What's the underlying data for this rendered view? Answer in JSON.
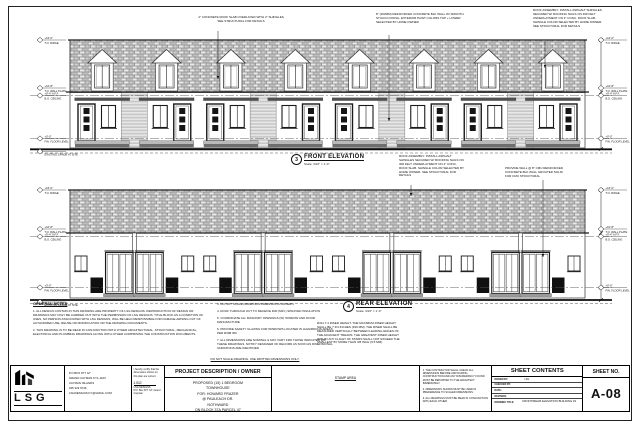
{
  "sheet": {
    "building": {
      "dormers": 8,
      "units": 8,
      "unit_pairs": 4
    },
    "front": {
      "number": "3",
      "title": "FRONT ELEVATION",
      "scale": "Scale: 3/16\" = 1'-0\"",
      "note_roof_slab": "4\" CONCRETE ROOF SLAB OVERLAYED WITH 2\" SHINGLES SEE STRUCTURAL FOR DETAILS",
      "note_wall": "8\" (203MM) REINFORCED CONCRETE BLK WALL W/ SMOOTH STUCCO FINISH. EXTERIOR PAINT COLORS TOP + LOWER SELECTED BY HOME OWNER",
      "levels": [
        {
          "y": 40,
          "elev": "+16'-0\"",
          "name": "T.O. RIDGE"
        },
        {
          "y": 88,
          "elev": "+10'-8\"",
          "name": "T.O. WALL PLATE"
        },
        {
          "y": 95.5,
          "elev": "+9'-4\" A.F.F.",
          "name": "B.O. CEILING"
        },
        {
          "y": 138.5,
          "elev": "+0'-0\"",
          "name": "FIN. FLOOR LEVEL"
        },
        {
          "y": 151.5,
          "elev": "",
          "name": "EXISTING GRADE AT SITE"
        }
      ]
    },
    "rear": {
      "number": "4",
      "title": "REAR ELEVATION",
      "scale": "Scale: 3/16\" = 1'-0\"",
      "note_wall": "PROVIDE WALL @ 8\" CMU REINFORCED CONCRETE BLK WALL GROUTED SOLID FOR CMU STRUCTURAL",
      "note_riser": "R311.7.4 RISER HEIGHT. THE MAXIMUM RISER HEIGHT SHALL BE 7 3/4 INCHES (196 MM). THE RISER SHALL BE MEASURED VERTICALLY BETWEEN LEADING EDGES OF THE ADJACENT TREADS. THE GREATEST RISER HEIGHT WITHIN ANY FLIGHT OF STAIRS SHALL NOT EXCEED THE SMALLEST BY MORE THAN 3/8 INCH (9.5 MM).",
      "levels": [
        {
          "y": 190,
          "elev": "+16'-0\"",
          "name": "T.O. RIDGE"
        },
        {
          "y": 229,
          "elev": "+10'-8\"",
          "name": "T.O. WALL PLATE"
        },
        {
          "y": 236.5,
          "elev": "+9'-4\" A.F.F.",
          "name": "B.O. CEILING"
        },
        {
          "y": 287.5,
          "elev": "+0'-0\"",
          "name": "FIN. FLOOR LEVEL"
        },
        {
          "y": 302,
          "elev": "",
          "name": "EXISTING GRADE AT SITE"
        }
      ]
    },
    "note_roof_assembly": "ROOF ASSEMBLY: INSTALL ASPHALT SHINGLES SECURED W/ ROOFING NAILS ON 30# FELT UNDERLAYMENT ON 4\" CONC. ROOF SLAB. SHINGLE COLOR SELECTED BY HOME OWNER. SEE STRUCTURAL FOR DETAILS",
    "general_notes": {
      "heading": "GENERAL NOTES",
      "col1": [
        "1. ALL DESIGN CONTAIN IN THIS DRAWING ARE PROPERTY OF LSG DESIGNS. REPRODUCTION OF DESIGN OR DRAWINGS MAY ONLY BE CARRIED OUT WITH THE PERMISSION OF LSG DESIGNS. TITLE BLOCK AS A CONDITION OF USES, NO PERSON ASSOCIATED WITH LSG DESIGNS, WILL BE HELD RESPONSIBLE FOR DAMAGE ARISING OUT OF AUTHORIZED USE, REUSE OR MODIFICATION OR THE DRAWING DOCUMENTS.",
        "2. THIS DRAWING IS TO BE READ IN CONJUNCTION WITH OTHER ARCHITECTURAL, STRUCTURAL, MECHANICAL, ELECTRICAL AND PLUMBING DRAWINGS ALONG WITH OTHER COMPRISING THE CONSTRUCTION DOCUMENTS."
      ],
      "col2": [
        "3. DO NOT SCALE DRAWINGS DIMENSIONS GOVERN.",
        "4. ROOF THROUGH OUT TO RECEIVE R30 (MIN.) SPRAYED INSULATION",
        "5. COORDINATE ALL MASONRY OPENINGS (W) WINDOW AND DOOR MANUFACTURE",
        "6. PROVIDE SAFETY GLAZING FOR WINDOWS LOCATED IN HAZARDOUS AREAS PER R308 IRC",
        "7. ALL DIMENSIONS ARE NOMINAL & MAY VARY FRO THOSE INDICATED ON THESE DRAWINGS. NOTIFY DESIGNER OF RECORD AS SOON AS DIMENSIONAL VARIATIONS ARE IDENTIFIED"
      ]
    },
    "footer_note": "DO NOT SCALE DRAWING. USE WRITTEN DIMENSIONS ONLY.",
    "title_block": {
      "logo": {
        "text": "LSG",
        "sub": "DESIGNS"
      },
      "address": [
        "P.O BOX 877 GT",
        "GRAND CAYMAN KY1-1103",
        "CAYMAN ISLANDS",
        "345 323 9746",
        "LSGDESIGNS.KY@GMAIL.COM"
      ],
      "certification": {
        "statement": "I hereby certify that the dimensions shown on this plan are correct.",
        "signature": "LSG",
        "name": "LSG DESIGNS",
        "address": "P.O. Box 877 GT, Grand Cayman"
      },
      "project": {
        "heading": "PROJECT DESCRIPTION / OWNER",
        "lines": [
          "PROPOSED (15) 1 BEDROOM",
          "TOWNHOUSE",
          "FOR: HOWARD FRAZER",
          "@ PAULEACH DR.",
          "NOTHWARD",
          "ON  BLOCK 37A PARCEL 47"
        ]
      },
      "stamp_label": "STAMP AREA",
      "notes": [
        "1. THE CONTRACTOR SHALL CHECK ALL DIMENSIONS BEFORE AND DURING CONSTRUCTION AND ANY DISCREPANCY FOUND MUST BE REPORTED TO THE ARCHITECT IMMEDIATELY.",
        "2. DIMENSIONS SHOWN MUST BE USED IN PREFERENCE TO SCALED DIMENSIONS.",
        "3. ALL DRAWINGS MUST BE READ IN CONJUNCTION WITH EACH OTHER."
      ],
      "sheet_contents": {
        "heading": "SHEET CONTENTS",
        "fields": [
          {
            "label": "DRAWN BY:",
            "value": "LSG"
          },
          {
            "label": "CHECKED BY:",
            "value": ""
          },
          {
            "label": "DATE:",
            "value": ""
          },
          {
            "label": "REVISION:",
            "value": ""
          }
        ],
        "title_label": "DRAWING TITLE:",
        "title_value": "FRONT/REAR ELEVATION BUILDING #1"
      },
      "sheet_no": {
        "heading": "SHEET NO.",
        "value": "A-08"
      }
    },
    "colors": {
      "line": "#1a1a1a",
      "shingle_base": "#d6d6d6",
      "accent_dark": "#4f4f4f",
      "paper": "#ffffff"
    }
  }
}
